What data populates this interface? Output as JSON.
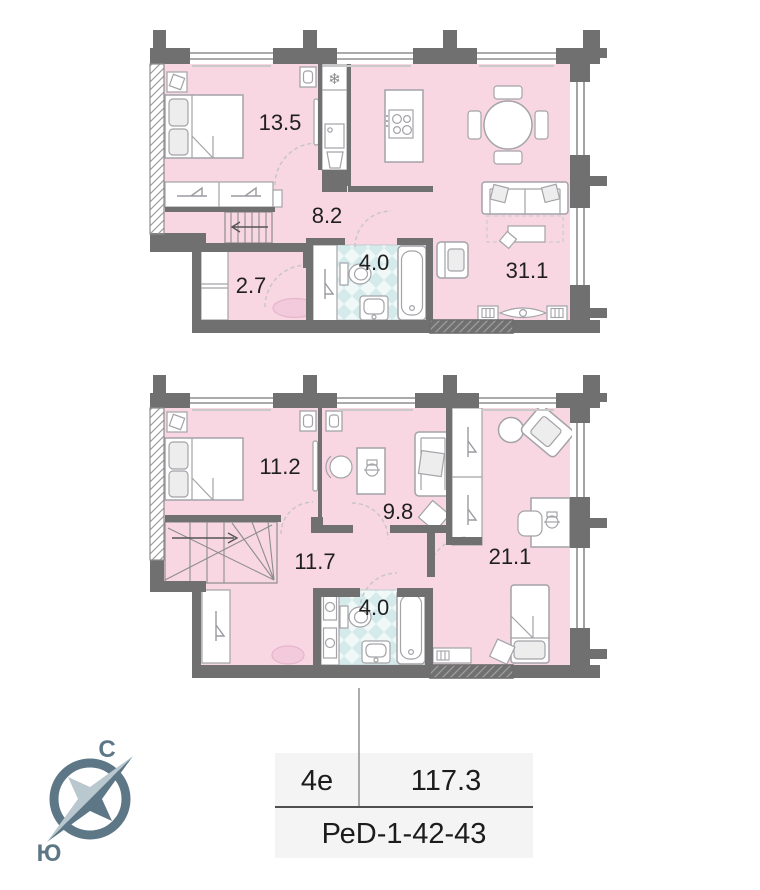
{
  "floors": [
    {
      "id": "upper",
      "rooms": [
        {
          "name": "bedroom",
          "area": "13.5"
        },
        {
          "name": "hallway",
          "area": "8.2"
        },
        {
          "name": "storage",
          "area": "2.7"
        },
        {
          "name": "bathroom",
          "area": "4.0"
        },
        {
          "name": "kitchen-living",
          "area": "31.1"
        }
      ]
    },
    {
      "id": "lower",
      "rooms": [
        {
          "name": "bedroom",
          "area": "11.2"
        },
        {
          "name": "room",
          "area": "9.8"
        },
        {
          "name": "hallway",
          "area": "11.7"
        },
        {
          "name": "bathroom",
          "area": "4.0"
        },
        {
          "name": "room",
          "area": "21.1"
        }
      ]
    }
  ],
  "compass": {
    "north_label": "С",
    "south_label": "Ю"
  },
  "info_table": {
    "type": "4е",
    "area": "117.3",
    "code": "РеD-1-42-43"
  },
  "icons": {
    "fridge_snowflake": "❄"
  },
  "colors": {
    "room_fill": "#f8d7e2",
    "wall": "#707070",
    "tile": "#d5eaeb",
    "compass": "#5d7787",
    "table_bg": "#f4f4f4",
    "rug": "#f3cadb"
  }
}
